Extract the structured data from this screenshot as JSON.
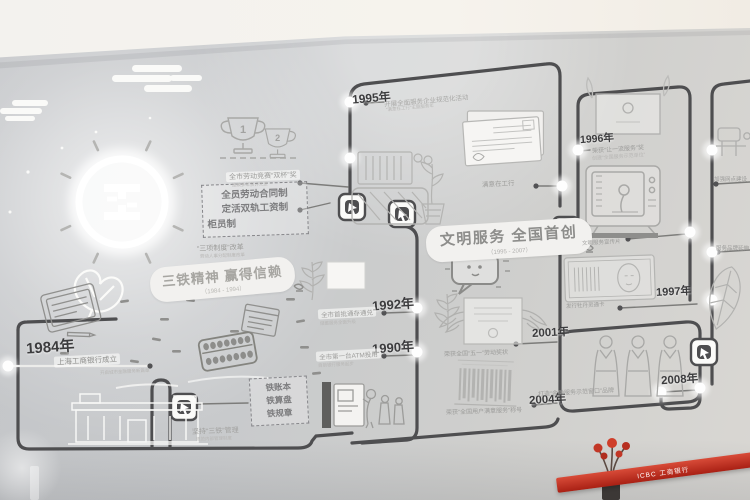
{
  "wall": {
    "era1": {
      "title": "三铁精神 赢得信赖",
      "subtitle": "（1984 - 1994）"
    },
    "era2": {
      "title": "文明服务 全国首创",
      "subtitle": "（1995 - 2007）"
    },
    "reform_box": {
      "line1": "全员劳动合同制",
      "line2": "定活双轨工资制",
      "line3": "柜员制",
      "caption": "“三项制度”改革",
      "caption_sub": "劳动人事分配制度改革"
    },
    "iron_box": {
      "line1": "铁账本",
      "line2": "铁算盘",
      "line3": "铁规章",
      "caption": "坚持“三铁”管理",
      "caption_sub": "规范内部管理制度"
    },
    "trophy": {
      "first": "1",
      "second": "2",
      "caption": "全市劳动竞赛“双杯”奖",
      "caption_sub": "连续多年获评先进"
    },
    "events": {
      "e1984": {
        "year": "1984年",
        "caption": "上海工商银行成立",
        "sub": "开启城市金融服务新篇章"
      },
      "e1990": {
        "year": "1990年",
        "caption": "全市第一台ATM投用",
        "sub": "自助银行服务起步"
      },
      "e1992": {
        "year": "1992年",
        "caption": "全市首批通存通兑",
        "sub": "储蓄服务全面升级"
      },
      "e1995": {
        "year": "1995年",
        "caption": "开展全面服务企业规范化活动",
        "sub": "“满意在工行”主题服务年"
      },
      "e1996": {
        "year": "1996年",
        "caption": "荣获“让一流服务”奖",
        "sub": "创建“全国服务示范单位”"
      },
      "e1997": {
        "year": "1997年",
        "caption": "发行牡丹灵通卡"
      },
      "e2001": {
        "year": "2001年",
        "caption": "荣获全国“五一”劳动奖状"
      },
      "e2004": {
        "year": "2004年",
        "caption": "荣获“全国用户满意服务”称号"
      },
      "e2008": {
        "year": "2008年",
        "caption": "打造“金融服务示范窗口”品牌"
      }
    },
    "satisfied_caption": "满意在工行",
    "tv_caption": "文明服务宣传片",
    "right_fragment1": "加强网点建设",
    "right_fragment2": "服务品牌延伸"
  },
  "banner": {
    "text": "ICBC 工商银行"
  }
}
